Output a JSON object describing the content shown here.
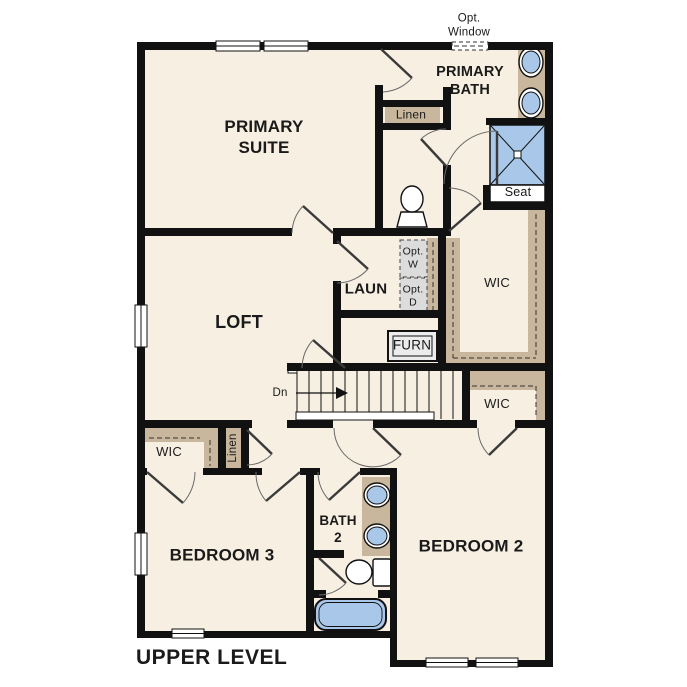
{
  "title": "UPPER LEVEL",
  "labels": {
    "opt_window": "Opt.\nWindow",
    "primary_suite": "PRIMARY\nSUITE",
    "primary_bath": "PRIMARY\nBATH",
    "linen_primary": "Linen",
    "seat": "Seat",
    "wic_primary": "WIC",
    "laundry": "LAUN",
    "opt_washer": "Opt.\nW",
    "opt_dryer": "Opt.\nD",
    "furnace": "FURN",
    "loft": "LOFT",
    "stairs_down": "Dn",
    "wic_bedroom2": "WIC",
    "wic_bedroom3": "WIC",
    "linen_hall": "Linen",
    "bedroom3": "BEDROOM 3",
    "bath2": "BATH\n2",
    "bedroom2": "BEDROOM 2"
  },
  "colors": {
    "floor": "#f7efe2",
    "wall": "#111111",
    "wood": "#c8b79c",
    "water": "#a9c7e8",
    "appliance": "#dcdcdc",
    "paper": "#ffffff",
    "ink": "#1a1a1a"
  }
}
